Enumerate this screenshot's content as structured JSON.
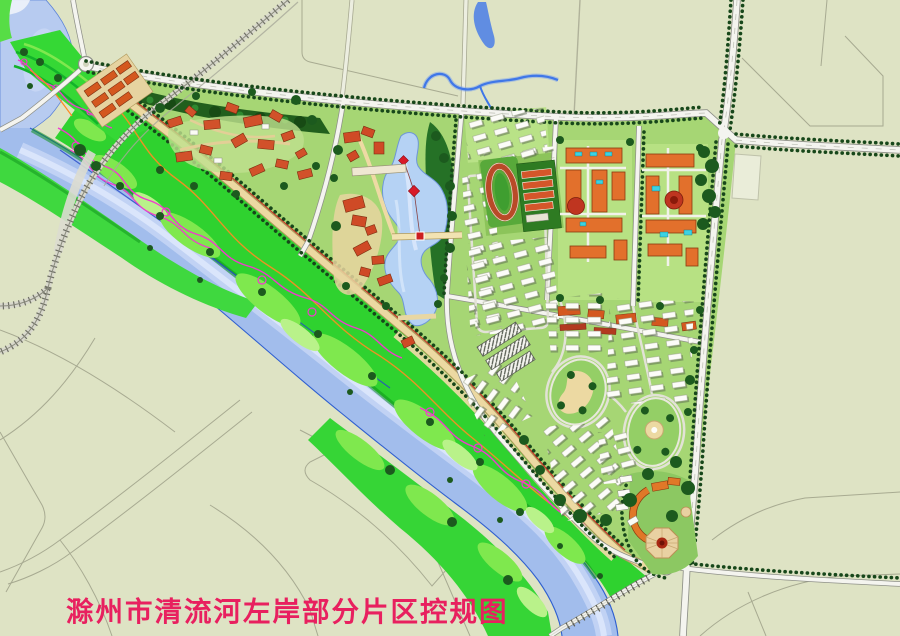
{
  "map": {
    "title": "滁州市清流河左岸部分片区控规图",
    "title_color": "#e8205f"
  },
  "legend_colors": {
    "field": "#dee3c4",
    "river_water": "#a2bdec",
    "park_green": "#2fd22f",
    "urban_green": "#a6d674",
    "building_orange": "#e2702c",
    "building_red": "#cf4a26",
    "road_white": "#f4f4ef",
    "greenway_tan": "#ecd9a2",
    "path_magenta": "#f03ace",
    "path_orange": "#ff8c22"
  },
  "features": [
    {
      "name": "qingliu-river"
    },
    {
      "name": "riverside-green-corridor"
    },
    {
      "name": "central-lake"
    },
    {
      "name": "stadium"
    },
    {
      "name": "school-campus"
    },
    {
      "name": "institutional-campus"
    },
    {
      "name": "residential-blocks"
    },
    {
      "name": "central-plaza"
    },
    {
      "name": "railway-crossing"
    },
    {
      "name": "arterial-road-junction"
    }
  ]
}
